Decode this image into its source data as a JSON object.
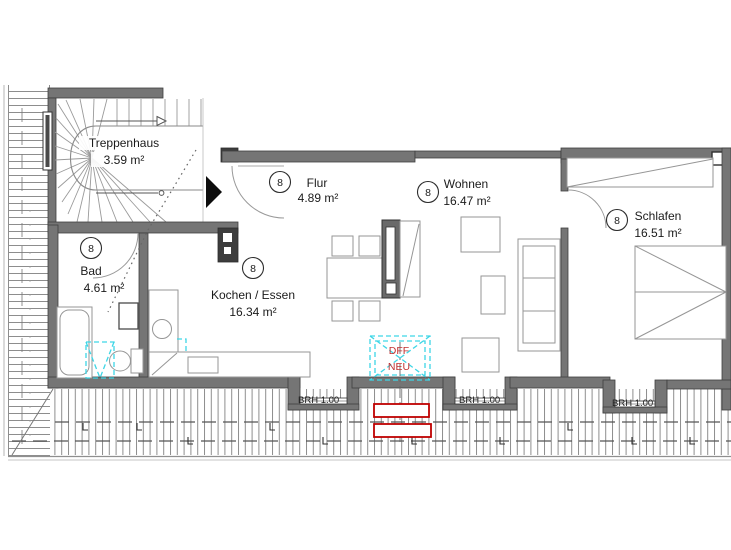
{
  "plan": {
    "rooms": [
      {
        "name": "Treppenhaus",
        "area": "3.59 m²",
        "number": ""
      },
      {
        "name": "Flur",
        "area": "4.89 m²",
        "number": "8"
      },
      {
        "name": "Wohnen",
        "area": "16.47 m²",
        "number": "8"
      },
      {
        "name": "Schlafen",
        "area": "16.51 m²",
        "number": "8"
      },
      {
        "name": "Bad",
        "area": "4.61 m²",
        "number": "8"
      },
      {
        "name": "Kochen / Essen",
        "area": "16.34 m²",
        "number": "8"
      }
    ],
    "sills": [
      {
        "label": "BRH 1.00"
      },
      {
        "label": "BRH 1.00"
      },
      {
        "label": "BRH 1.00"
      }
    ],
    "roof_window": {
      "line1": "DFF",
      "line2": "NEU"
    },
    "colors": {
      "marker_cyan": "#3ed6e6",
      "highlight_red": "#bf0000",
      "text_red": "#c03030"
    }
  }
}
